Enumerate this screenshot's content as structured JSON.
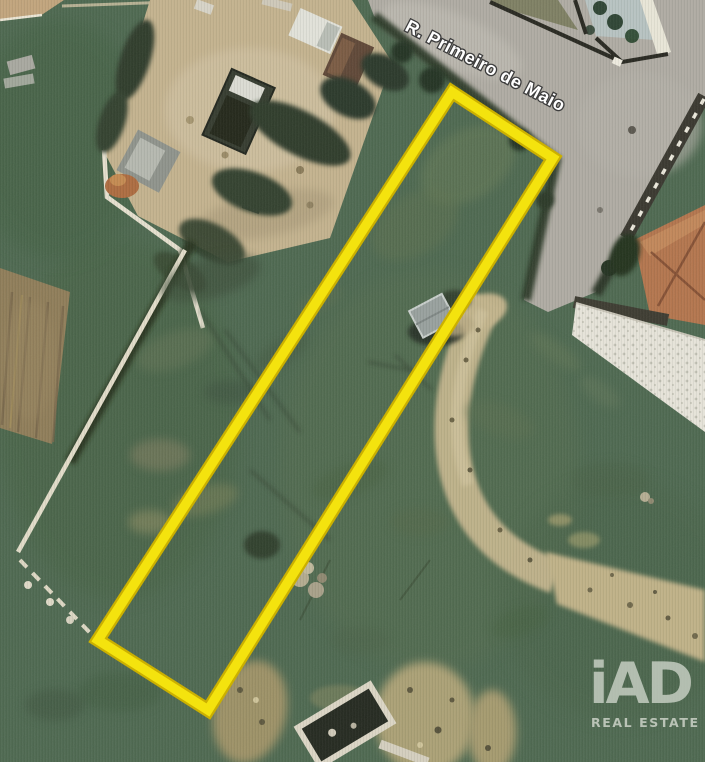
{
  "aerial_view": {
    "street_label": "R. Primeiro de Maio"
  },
  "plot_outline": {
    "points": "452,92 553,158 208,710 98,640",
    "outline_color": "#F2DE0A",
    "outline_edge_color": "#CBB000"
  },
  "watermark": {
    "brand": "iAD",
    "tagline": "REAL ESTATE",
    "color": "#DFE3DA"
  }
}
